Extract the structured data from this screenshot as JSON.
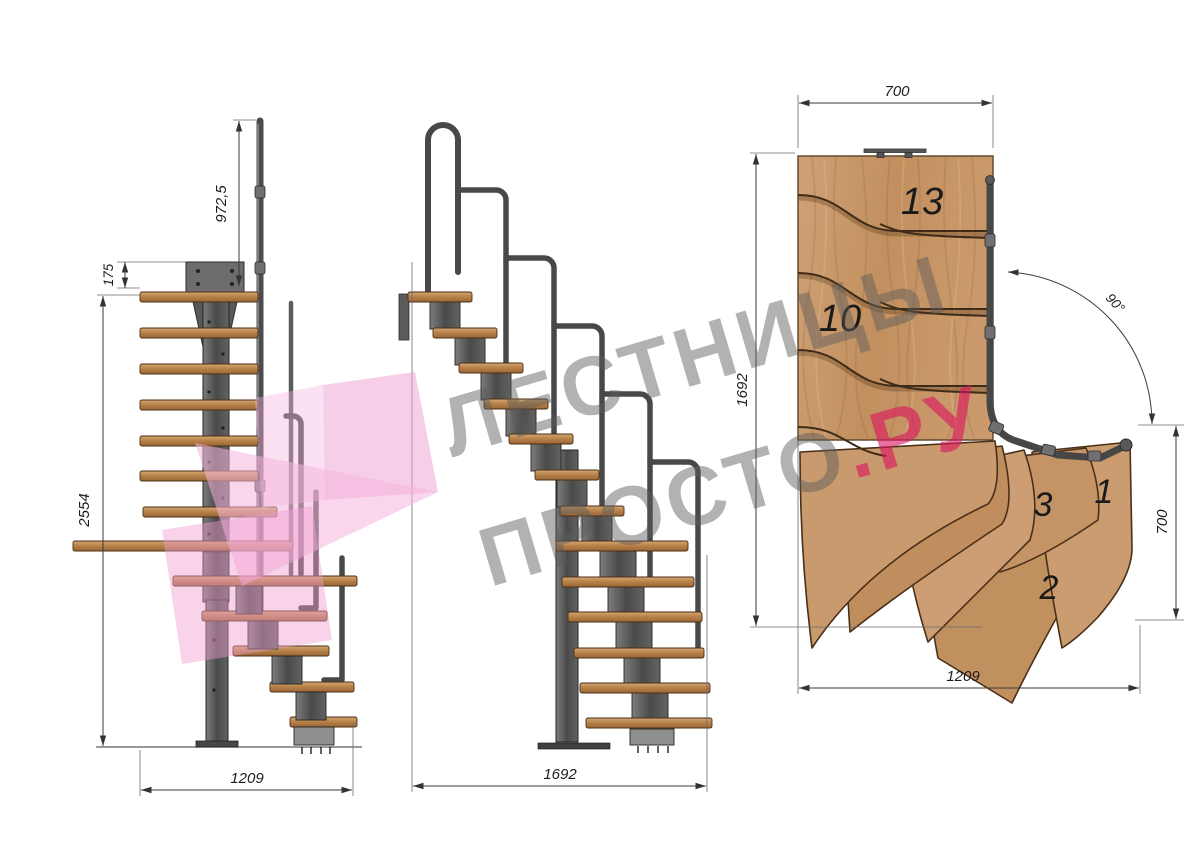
{
  "document": {
    "type": "staircase technical drawing, three views (side elevation, front elevation, top plan)"
  },
  "views": {
    "side": {
      "dims": {
        "rail_height": "972,5",
        "plate_offset": "175",
        "total_height": "2554",
        "base_width": "1209"
      }
    },
    "front": {
      "dims": {
        "base_width": "1692"
      }
    },
    "plan": {
      "dims": {
        "top_width": "700",
        "left_depth": "1692",
        "turn_angle": "90°",
        "right_depth": "700",
        "bottom_width": "1209"
      },
      "steps": {
        "s13": "13",
        "s10": "10",
        "s3": "3",
        "s1": "1",
        "s2": "2"
      }
    }
  },
  "watermark": {
    "line1": "ЛЕСТНИЦЫ",
    "line2": "ПРОСТО",
    "line2_accent": ".РУ"
  },
  "colors": {
    "wood": "#c79a6e",
    "wood_dark": "#b07a46",
    "steel": "#5f5f5f",
    "steel_dark": "#3b3b3b",
    "dimension": "#3a3a3a",
    "watermark_gray": "#a9a9a9",
    "watermark_pink": "#e2447c",
    "logo_pink": "#f0a2d2"
  }
}
